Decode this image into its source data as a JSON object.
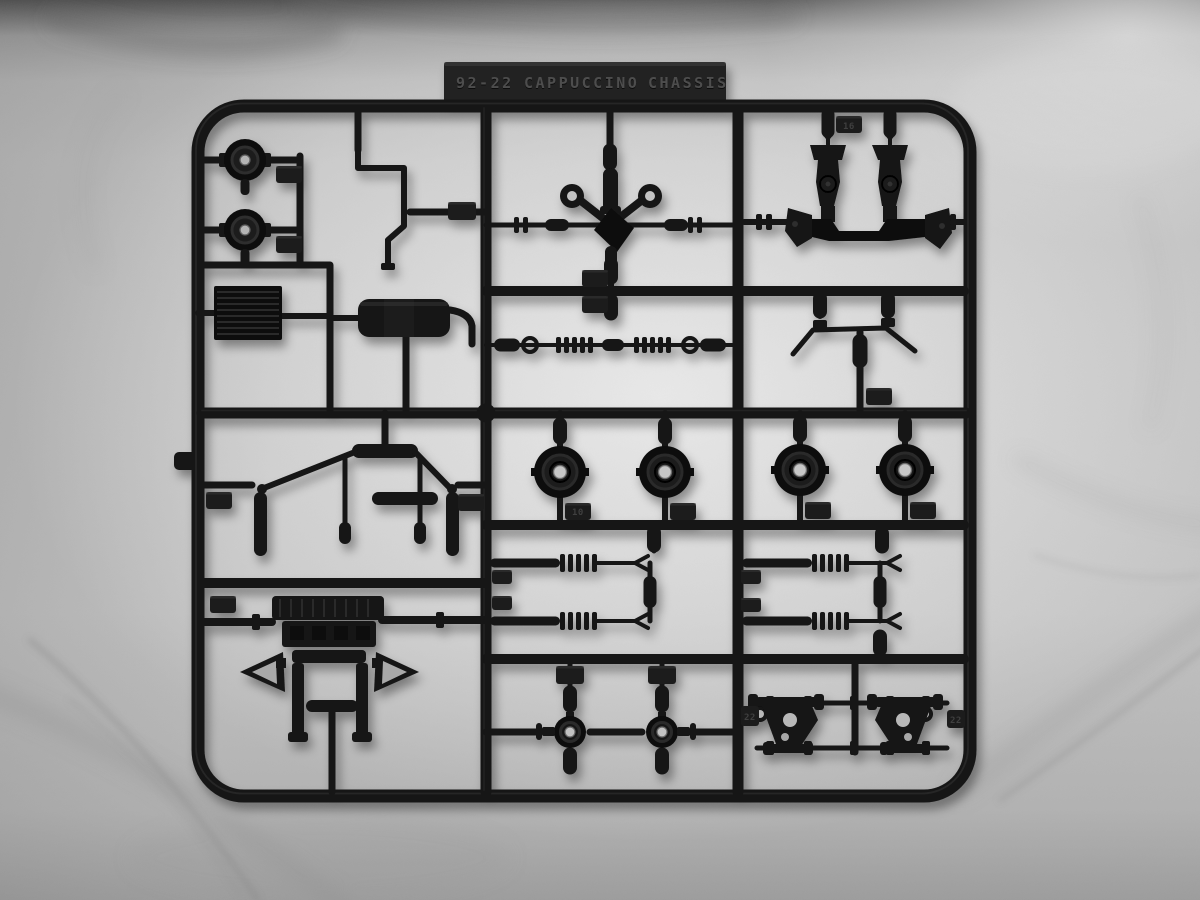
{
  "photo": {
    "subject": "Black injection-molded plastic model kit sprue on marble surface"
  },
  "sprue_label": {
    "kit_code": "92-22",
    "kit_name": "CAPPUCCINO",
    "sprue_name": "CHASSIS"
  },
  "part_number_tabs": {
    "subframe": "16",
    "center_hub": "10",
    "arm_left": "22",
    "arm_right": "22"
  },
  "parts": [
    "brake-drum (x2)",
    "radiator",
    "exhaust-pipe",
    "muffler",
    "rear-suspension-linkage",
    "engine-transmission-assembly",
    "steering-gear-and-driveshaft",
    "tie-rod",
    "front-subframe-strut-towers",
    "stabilizer-bar",
    "wheel-hub (x4)",
    "shock-absorber (x4)",
    "steering-knuckle (x2)",
    "lower-control-arm (x2)"
  ],
  "colors": {
    "plastic": "#161616",
    "plastic_highlight": "#323232",
    "tab_text": "#4d4d4d",
    "marble_light": "#dedede",
    "marble_mid": "#c2c2c2",
    "marble_dark": "#5f5f5f"
  }
}
